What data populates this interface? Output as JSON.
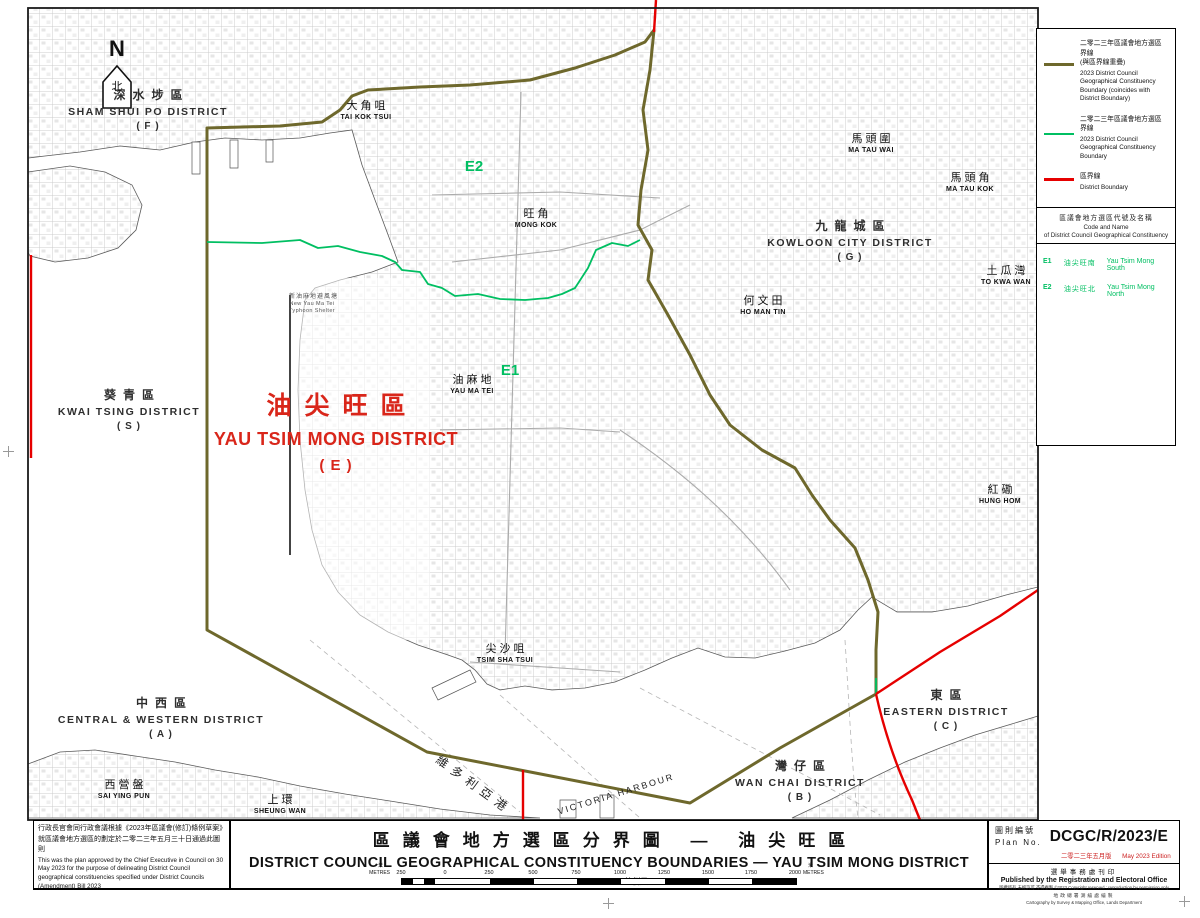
{
  "colors": {
    "olive": "#6e682c",
    "green": "#00bf62",
    "red": "#e60000",
    "labelred": "#d9261a",
    "edred": "#cc2222"
  },
  "north": {
    "label": "N",
    "cn": "北"
  },
  "map": {
    "districts": [
      {
        "cn": "深水埗區",
        "en": "SHAM SHUI PO DISTRICT",
        "code": "( F )",
        "x": 148,
        "y": 86
      },
      {
        "cn": "葵青區",
        "en": "KWAI TSING DISTRICT",
        "code": "( S )",
        "x": 129,
        "y": 386
      },
      {
        "cn": "九龍城區",
        "en": "KOWLOON CITY DISTRICT",
        "code": "( G )",
        "x": 850,
        "y": 217
      },
      {
        "cn": "中西區",
        "en": "CENTRAL & WESTERN DISTRICT",
        "code": "( A )",
        "x": 161,
        "y": 694
      },
      {
        "cn": "灣仔區",
        "en": "WAN CHAI DISTRICT",
        "code": "( B )",
        "x": 800,
        "y": 757
      },
      {
        "cn": "東區",
        "en": "EASTERN DISTRICT",
        "code": "( C )",
        "x": 946,
        "y": 686
      },
      {
        "cn": "油尖旺區",
        "en": "YAU TSIM MONG DISTRICT",
        "code": "( E )",
        "x": 336,
        "y": 386,
        "cls": "main"
      }
    ],
    "areas": [
      {
        "cn": "大角咀",
        "en": "TAI KOK TSUI",
        "x": 366,
        "y": 97
      },
      {
        "cn": "旺角",
        "en": "MONG KOK",
        "x": 536,
        "y": 205
      },
      {
        "cn": "馬頭圍",
        "en": "MA TAU WAI",
        "x": 871,
        "y": 130
      },
      {
        "cn": "馬頭角",
        "en": "MA TAU KOK",
        "x": 970,
        "y": 169
      },
      {
        "cn": "土瓜灣",
        "en": "TO KWA WAN",
        "x": 1006,
        "y": 262
      },
      {
        "cn": "何文田",
        "en": "HO MAN TIN",
        "x": 763,
        "y": 292
      },
      {
        "cn": "油麻地",
        "en": "YAU MA TEI",
        "x": 472,
        "y": 371
      },
      {
        "cn": "紅磡",
        "en": "HUNG HOM",
        "x": 1000,
        "y": 481
      },
      {
        "cn": "尖沙咀",
        "en": "TSIM SHA TSUI",
        "x": 505,
        "y": 640
      },
      {
        "cn": "西營盤",
        "en": "SAI YING PUN",
        "x": 124,
        "y": 776
      },
      {
        "cn": "上環",
        "en": "SHEUNG WAN",
        "x": 280,
        "y": 791
      },
      {
        "cn": "新油麻地避風塘",
        "en": "New Yau Ma Tei",
        "en2": "Typhoon Shelter",
        "x": 312,
        "y": 291,
        "cls": "tiny"
      }
    ],
    "codes": [
      {
        "code": "E1",
        "x": 510,
        "y": 362
      },
      {
        "code": "E2",
        "x": 474,
        "y": 158
      }
    ],
    "harbour": [
      {
        "text": "維多利亞港",
        "x": 474,
        "y": 776,
        "rotate": 36,
        "cls": "vh-cn"
      },
      {
        "text": "VICTORIA HARBOUR",
        "x": 616,
        "y": 789,
        "rotate": -17,
        "cls": "vh-en"
      }
    ]
  },
  "legend": {
    "items": [
      {
        "cn1": "二零二三年區議會地方選區界線",
        "cn2": "(與區界線重疊)",
        "en": "2023 District Council Geographical Constituency Boundary (coincides with District Boundary)"
      },
      {
        "cn1": "二零二三年區議會地方選區界線",
        "cn2": "",
        "en": "2023 District Council Geographical Constituency Boundary"
      },
      {
        "cn1": "區界線",
        "cn2": "",
        "en": "District Boundary"
      }
    ],
    "code_header_cn": "區議會地方選區代號及名稱",
    "code_header_en1": "Code and Name",
    "code_header_en2": "of District Council Geographical Constituency",
    "codes": [
      {
        "code": "E1",
        "cn": "油尖旺南",
        "en": "Yau Tsim Mong South"
      },
      {
        "code": "E2",
        "cn": "油尖旺北",
        "en": "Yau Tsim Mong North"
      }
    ]
  },
  "approval": {
    "cn": "行政長官會同行政會議根據《2023年區議會(修訂)條例草案》就區議會地方選區的劃定於二零二三年五月三十日通過此圖則",
    "en": "This was the plan approved by the Chief Executive in Council on 30 May 2023 for the purpose of delineating District Council geographical constituencies specified under District Councils (Amendment) Bill 2023"
  },
  "title_block": {
    "cn": "區議會地方選區分界圖 — 油尖旺區",
    "en": "DISTRICT COUNCIL GEOGRAPHICAL CONSTITUENCY BOUNDARIES — YAU TSIM MONG DISTRICT",
    "scale": "SCALE 1:8 000 比例尺"
  },
  "scale_bar": {
    "unit_cn": "米",
    "unit_en": "METRES",
    "ticks": [
      {
        "t": "250",
        "x": 401
      },
      {
        "t": "0",
        "x": 445
      },
      {
        "t": "250",
        "x": 489
      },
      {
        "t": "500",
        "x": 533
      },
      {
        "t": "750",
        "x": 576
      },
      {
        "t": "1000",
        "x": 620
      },
      {
        "t": "1250",
        "x": 664
      },
      {
        "t": "1500",
        "x": 708
      },
      {
        "t": "1750",
        "x": 751
      },
      {
        "t": "2000",
        "x": 795
      }
    ]
  },
  "plan_block": {
    "label_cn": "圖則編號",
    "label_en": "Plan No.",
    "number": "DCGC/R/2023/E",
    "edition_cn": "二零二三年五月版",
    "edition_en": "May 2023 Edition",
    "publisher_cn": "選舉事務處刊印",
    "publisher_en": "Published by the Registration and Electoral Office",
    "copyright": "版權所有 未經許可 不得複製 ©2023 Copyright reserved : reproduction by permission only",
    "carto_cn": "地政總署測繪處繪製",
    "carto_en": "Cartography by Survey & Mapping Office, Lands Department"
  }
}
